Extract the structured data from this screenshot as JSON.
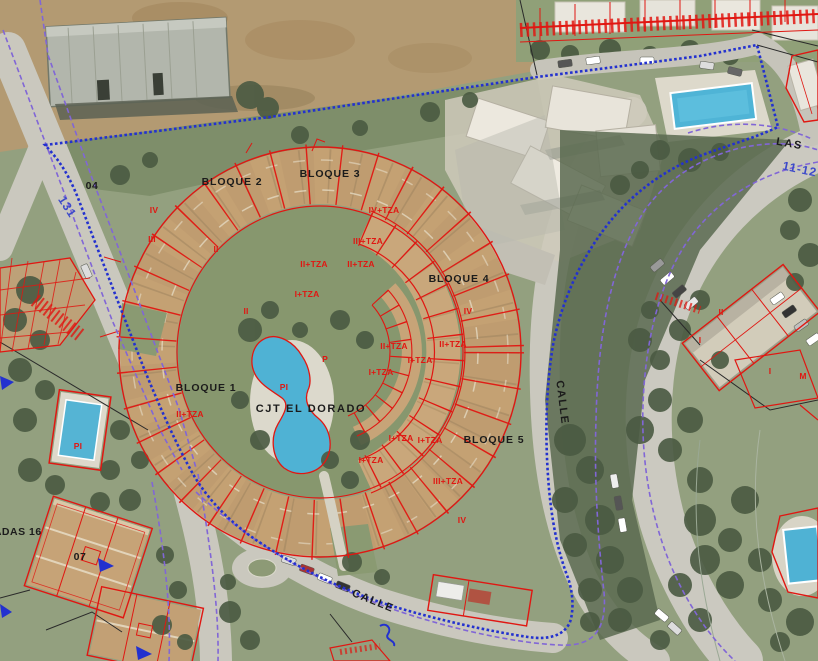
{
  "map": {
    "kind": "cadastral-parcel-overlay-on-aerial-photo",
    "labels": [
      {
        "kind": "block",
        "text": "BLOQUE 2",
        "x": 232,
        "y": 185
      },
      {
        "kind": "block",
        "text": "BLOQUE 3",
        "x": 330,
        "y": 177
      },
      {
        "kind": "block",
        "text": "BLOQUE 4",
        "x": 459,
        "y": 282
      },
      {
        "kind": "block",
        "text": "BLOQUE 1",
        "x": 206,
        "y": 391
      },
      {
        "kind": "block",
        "text": "BLOQUE 5",
        "x": 494,
        "y": 443
      },
      {
        "kind": "street",
        "text": "CJT EL DORADO",
        "x": 311,
        "y": 412
      },
      {
        "kind": "street",
        "text": "CALLE",
        "x": 372,
        "y": 604,
        "rot": 22
      },
      {
        "kind": "street",
        "text": "CALLE",
        "x": 559,
        "y": 403,
        "rot": 83
      },
      {
        "kind": "street",
        "text": "LAS",
        "x": 789,
        "y": 147,
        "rot": 10
      },
      {
        "kind": "ref",
        "text": "GRUPADAS 16",
        "x": 2,
        "y": 535,
        "anchor": "start"
      },
      {
        "kind": "ref",
        "text": "07",
        "x": 80,
        "y": 560
      },
      {
        "kind": "ref",
        "text": "04",
        "x": 92,
        "y": 189
      },
      {
        "kind": "blue",
        "text": "131",
        "x": 64,
        "y": 209,
        "rot": 57
      },
      {
        "kind": "blue",
        "text": "11-12",
        "x": 799,
        "y": 173,
        "rot": 12
      },
      {
        "kind": "red",
        "text": "IV",
        "x": 154,
        "y": 213
      },
      {
        "kind": "red",
        "text": "III",
        "x": 152,
        "y": 242
      },
      {
        "kind": "red",
        "text": "II",
        "x": 216,
        "y": 252
      },
      {
        "kind": "red",
        "text": "II",
        "x": 246,
        "y": 314
      },
      {
        "kind": "red",
        "text": "IV+TZA",
        "x": 384,
        "y": 213
      },
      {
        "kind": "red",
        "text": "III+TZA",
        "x": 368,
        "y": 244
      },
      {
        "kind": "red",
        "text": "II+TZA",
        "x": 314,
        "y": 267
      },
      {
        "kind": "red",
        "text": "II+TZA",
        "x": 361,
        "y": 267
      },
      {
        "kind": "red",
        "text": "I+TZA",
        "x": 307,
        "y": 297
      },
      {
        "kind": "red",
        "text": "II+TZA",
        "x": 394,
        "y": 349
      },
      {
        "kind": "red",
        "text": "II+TZA",
        "x": 453,
        "y": 347
      },
      {
        "kind": "red",
        "text": "I+TZA",
        "x": 420,
        "y": 363
      },
      {
        "kind": "red",
        "text": "I+TZA",
        "x": 381,
        "y": 375
      },
      {
        "kind": "red",
        "text": "IV",
        "x": 468,
        "y": 314
      },
      {
        "kind": "red",
        "text": "P",
        "x": 325,
        "y": 362
      },
      {
        "kind": "red",
        "text": "PI",
        "x": 284,
        "y": 390
      },
      {
        "kind": "red",
        "text": "I+TZA",
        "x": 401,
        "y": 441
      },
      {
        "kind": "red",
        "text": "I+TZA",
        "x": 430,
        "y": 443
      },
      {
        "kind": "red",
        "text": "I+TZA",
        "x": 371,
        "y": 463
      },
      {
        "kind": "red",
        "text": "III+TZA",
        "x": 448,
        "y": 484
      },
      {
        "kind": "red",
        "text": "IV",
        "x": 462,
        "y": 523
      },
      {
        "kind": "red",
        "text": "II+TZA",
        "x": 190,
        "y": 417
      },
      {
        "kind": "red",
        "text": "PI",
        "x": 78,
        "y": 449
      },
      {
        "kind": "red",
        "text": "II",
        "x": 721,
        "y": 315
      },
      {
        "kind": "red",
        "text": "I",
        "x": 700,
        "y": 343
      },
      {
        "kind": "red",
        "text": "I",
        "x": 770,
        "y": 374
      },
      {
        "kind": "red",
        "text": "M",
        "x": 803,
        "y": 379
      }
    ]
  },
  "colors": {
    "parcel_red": "#e01712",
    "boundary_blue": "#2331cf",
    "street_purple": "#8166d6",
    "label_black": "#1b1b1b",
    "label_blue": "#3d4ac9",
    "pool_water": "#4fb2d4"
  }
}
